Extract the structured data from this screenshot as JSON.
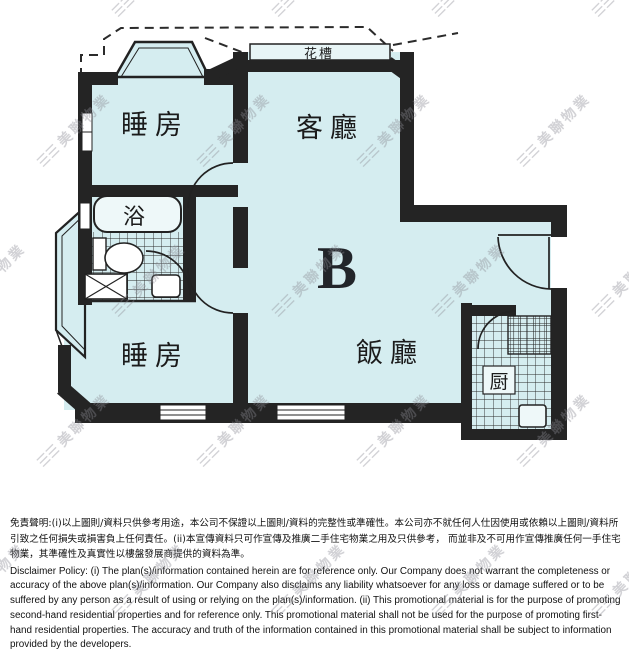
{
  "watermark": {
    "logo": "☰☰",
    "text": "美聯物業"
  },
  "floor_plan": {
    "unit_label": "B",
    "labels": {
      "bedroom_top": "睡房",
      "living_room": "客廳",
      "bath": "浴",
      "bedroom_bottom": "睡房",
      "dining_room": "飯廳",
      "kitchen": "厨",
      "flower_trough": "花槽"
    },
    "colors": {
      "room_fill": "#d5edf0",
      "wall": "#242424",
      "fixture_fill": "#eef8f9"
    }
  },
  "disclaimer": {
    "chinese": "免責聲明:(i)以上圖則/資料只供參考用途，本公司不保證以上圖則/資料的完整性或準確性。本公司亦不就任何人仕因使用或依賴以上圖則/資料所引致之任何損失或損害負上任何責任。(ii)本宣傳資料只可作宣傳及推廣二手住宅物業之用及只供參考， 而並非及不可用作宣傳推廣任何一手住宅物業，其準確性及真實性以樓盤發展商提供的資料為準。",
    "english": "Disclaimer Policy: (i) The plan(s)/information contained herein are for reference only. Our Company does not warrant the completeness or accuracy of the above plan(s)/information. Our Company also disclaims any liability whatsoever for any loss or damage suffered or to be suffered by any person as a result of using or relying on the plan(s)/information. (ii) This promotional material is for the purpose of promoting second-hand residential properties and for reference only. This promotional material shall not be used for the purpose of promoting first-hand residential properties. The accuracy and truth of the information contained in this promotional material shall be subject to information provided by the developers."
  }
}
